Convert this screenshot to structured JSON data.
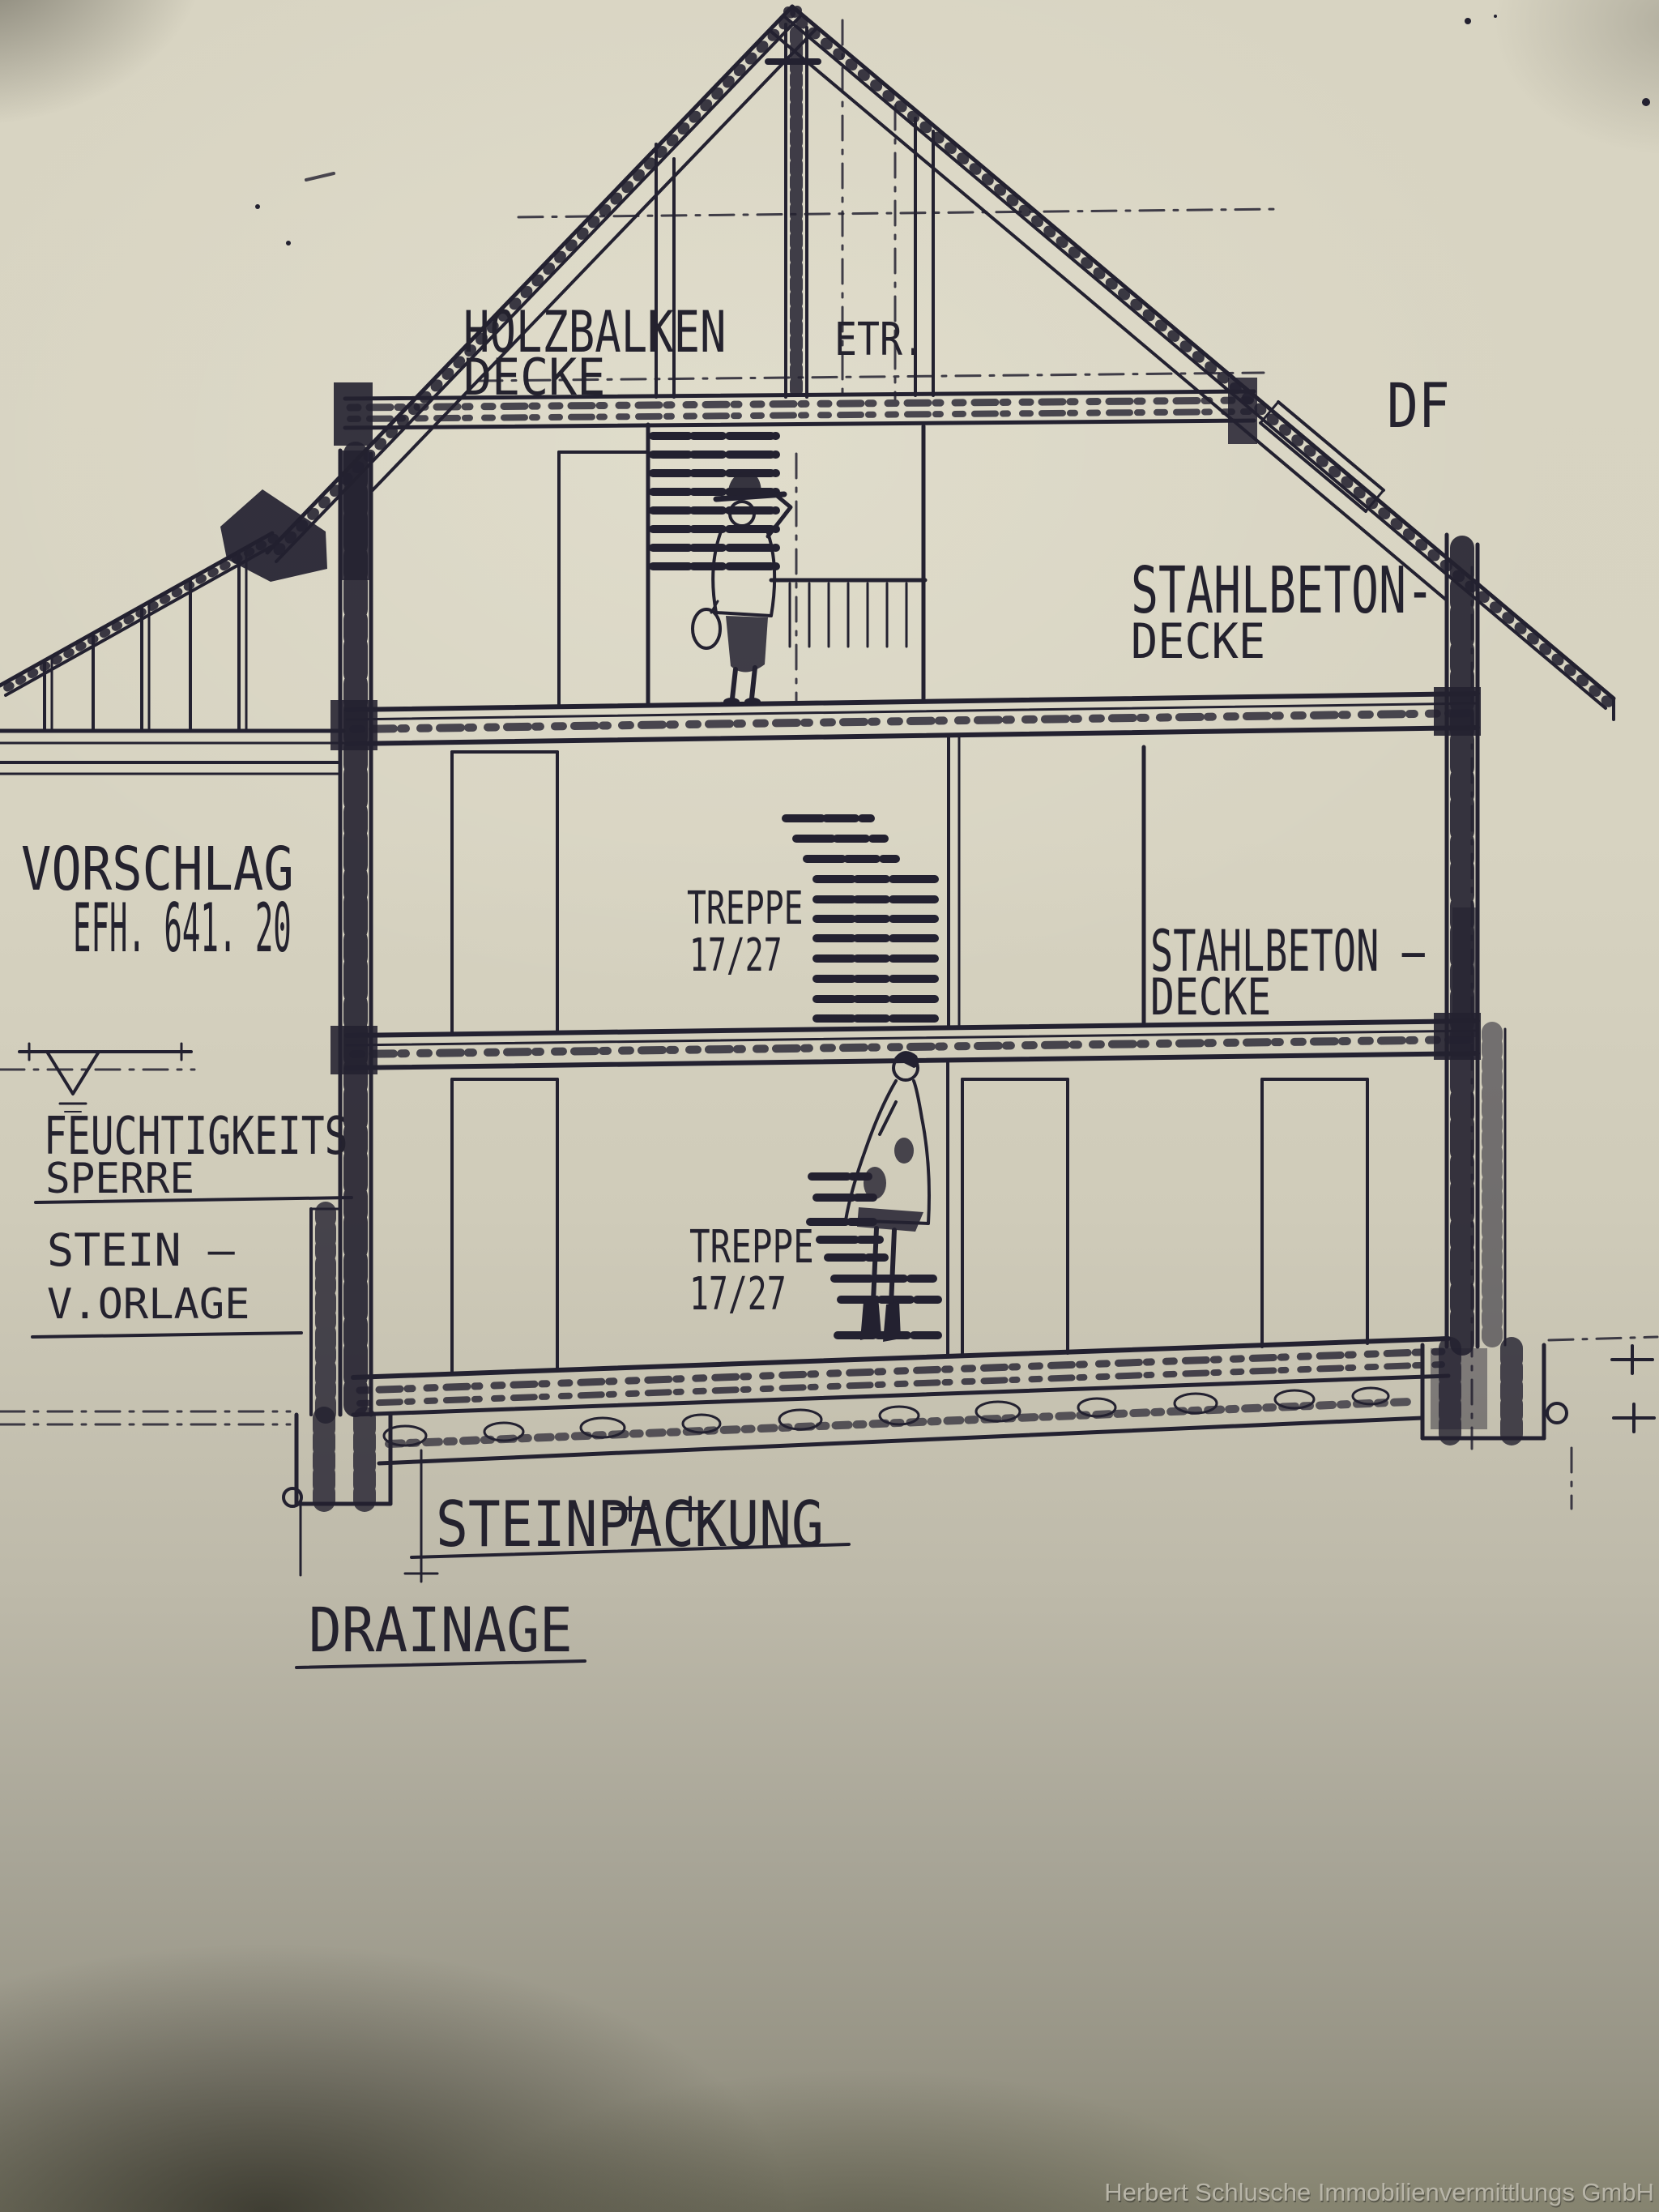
{
  "drawing": {
    "labels": {
      "attic_ceiling_1": "HOLZBALKEN",
      "attic_ceiling_2": "DECKE",
      "etr": "ETR.",
      "df": "DF",
      "slab_upper_1": "STAHLBETON-",
      "slab_upper_2": "DECKE",
      "slab_lower_1": "STAHLBETON –",
      "slab_lower_2": "DECKE",
      "proposal_1": "VORSCHLAG",
      "proposal_2": "EFH. 641. 20",
      "moisture_1": "FEUCHTIGKEITS",
      "moisture_2": "SPERRE",
      "stone_facing_1": "STEIN –",
      "stone_facing_2": "V.ORLAGE",
      "stairs_upper_1": "TREPPE",
      "stairs_upper_2": "17/27",
      "stairs_lower_1": "TREPPE",
      "stairs_lower_2": "17/27",
      "stone_packing": "STEINPACKUNG",
      "drainage": "DRAINAGE"
    },
    "colors": {
      "paper": "#d6d2c0",
      "ink": "#232130",
      "watermark": "#b8b5a8"
    }
  },
  "watermark": {
    "text": "Herbert Schlusche Immobilienvermittlungs GmbH"
  }
}
